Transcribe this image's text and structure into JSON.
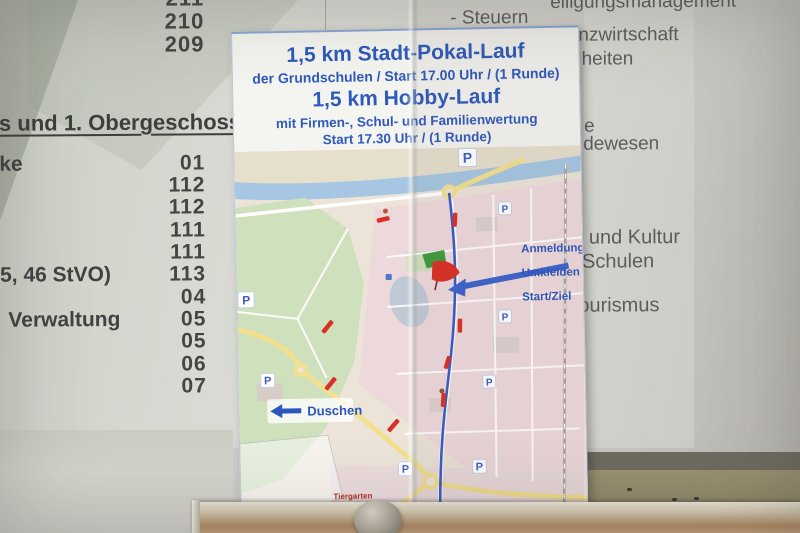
{
  "directory": {
    "room_numbers_top": [
      "211",
      "210",
      "209"
    ],
    "section_heading": "s und 1. Obergeschoss)",
    "rows": [
      {
        "label": "ke",
        "number": "01"
      },
      {
        "label": "",
        "number": "112"
      },
      {
        "label": "",
        "number": "112"
      },
      {
        "label": "",
        "number": "111"
      },
      {
        "label": "",
        "number": "111"
      },
      {
        "label": "5, 46 StVO)",
        "number": "113"
      },
      {
        "label": "",
        "number": "04"
      },
      {
        "label": "Verwaltung",
        "number": "05"
      },
      {
        "label": "",
        "number": "05"
      },
      {
        "label": "",
        "number": "06"
      },
      {
        "label": "",
        "number": "07"
      }
    ],
    "right_column_fragments": [
      {
        "text": "eiligungsmanagement"
      },
      {
        "text": "- Steuern"
      },
      {
        "text": "Finanzwirtschaft"
      },
      {
        "text": "heiten"
      },
      {
        "text": "e"
      },
      {
        "text": "dewesen"
      },
      {
        "text": "und Kultur"
      },
      {
        "text": "Schulen"
      },
      {
        "text": "ourismus"
      }
    ]
  },
  "poster": {
    "header": {
      "line1": "1,5 km Stadt-Pokal-Lauf",
      "line2": "der Grundschulen / Start 17.00 Uhr / (1 Runde)",
      "line3": "1,5 km Hobby-Lauf",
      "line4": "mit Firmen-, Schul- und Familienwertung",
      "line5": "Start 17.30 Uhr / (1 Runde)"
    },
    "map": {
      "labels": {
        "anmeldung_line1": "Anmeldung",
        "anmeldung_line2": "Umkleiden",
        "anmeldung_line3": "Start/Ziel",
        "duschen": "Duschen",
        "parking_symbol": "P",
        "caption_line1": "Tiergarten",
        "caption_line2": "Stadtlauf"
      },
      "colors": {
        "route_blue": "#3a5cc6",
        "marker_red": "#d93025",
        "park_green": "#cfe0bd",
        "urban_pink": "#edd9db",
        "river_blue": "#a6c6e3",
        "road_yellow": "#f2e08e",
        "text_blue": "#2d55bb"
      }
    }
  }
}
